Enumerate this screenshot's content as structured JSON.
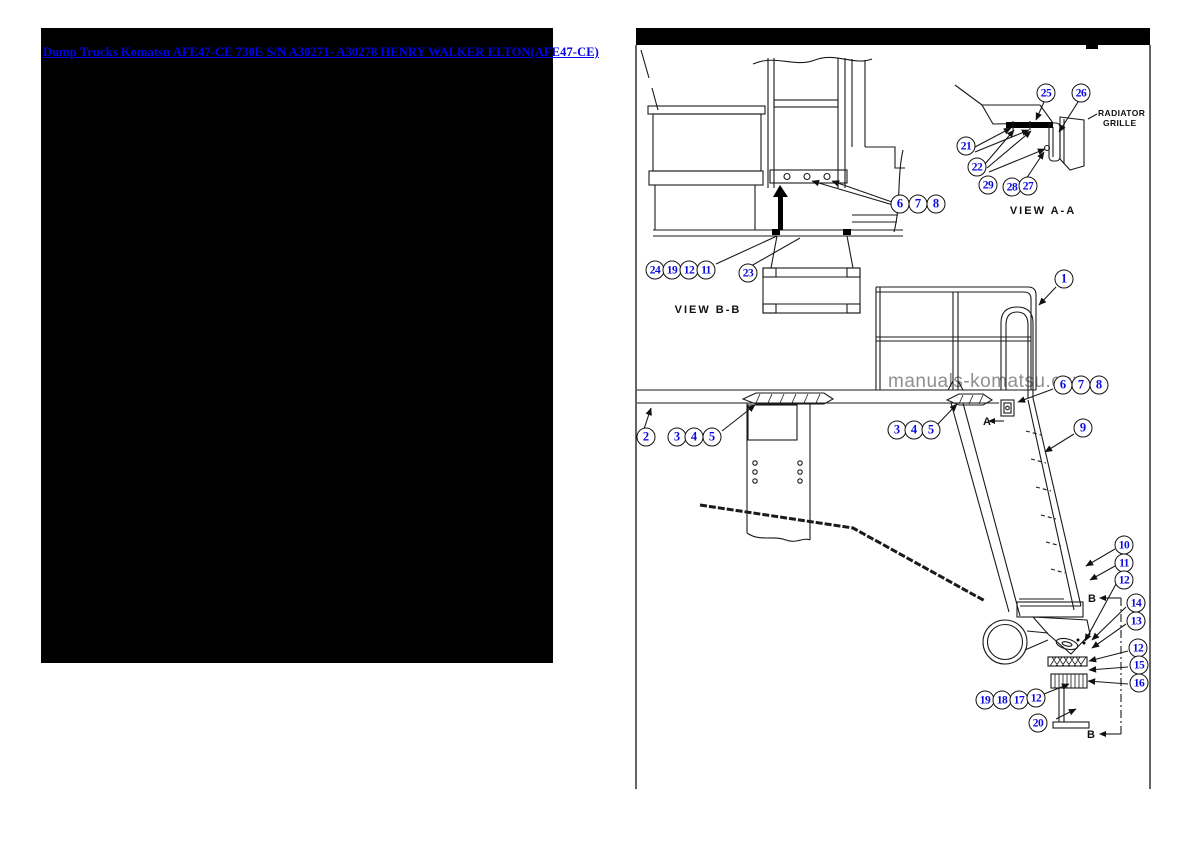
{
  "header_link": {
    "text": "Dump Trucks Komatsu AFE47-CE 730E S/N A30271- A30278 HENRY WALKER ELTON(AFE47-CE)",
    "color": "#0000ee"
  },
  "watermark": {
    "text": "manuals-komatsu.com",
    "color": "#8f8f8f"
  },
  "diagram": {
    "labels": {
      "view_aa": "VIEW A-A",
      "view_bb": "VIEW B-B",
      "radiator_line1": "RADIATOR",
      "radiator_line2": "GRILLE",
      "section_a": "A",
      "section_b": "B"
    },
    "callout_color": "#0a0ae0",
    "callouts": [
      {
        "n": "6",
        "x": 900,
        "y": 204
      },
      {
        "n": "7",
        "x": 918,
        "y": 204
      },
      {
        "n": "8",
        "x": 936,
        "y": 204
      },
      {
        "n": "24",
        "x": 655,
        "y": 270
      },
      {
        "n": "19",
        "x": 672,
        "y": 270
      },
      {
        "n": "12",
        "x": 689,
        "y": 270
      },
      {
        "n": "11",
        "x": 706,
        "y": 270
      },
      {
        "n": "23",
        "x": 748,
        "y": 273
      },
      {
        "n": "21",
        "x": 966,
        "y": 146
      },
      {
        "n": "22",
        "x": 977,
        "y": 167
      },
      {
        "n": "29",
        "x": 988,
        "y": 185
      },
      {
        "n": "28",
        "x": 1012,
        "y": 187
      },
      {
        "n": "27",
        "x": 1028,
        "y": 186
      },
      {
        "n": "25",
        "x": 1046,
        "y": 93
      },
      {
        "n": "26",
        "x": 1081,
        "y": 93
      },
      {
        "n": "1",
        "x": 1064,
        "y": 279
      },
      {
        "n": "6",
        "x": 1063,
        "y": 385
      },
      {
        "n": "7",
        "x": 1081,
        "y": 385
      },
      {
        "n": "8",
        "x": 1099,
        "y": 385
      },
      {
        "n": "9",
        "x": 1083,
        "y": 428
      },
      {
        "n": "2",
        "x": 646,
        "y": 437
      },
      {
        "n": "3",
        "x": 677,
        "y": 437
      },
      {
        "n": "4",
        "x": 694,
        "y": 437
      },
      {
        "n": "5",
        "x": 712,
        "y": 437
      },
      {
        "n": "3",
        "x": 897,
        "y": 430
      },
      {
        "n": "4",
        "x": 914,
        "y": 430
      },
      {
        "n": "5",
        "x": 931,
        "y": 430
      },
      {
        "n": "10",
        "x": 1124,
        "y": 545
      },
      {
        "n": "11",
        "x": 1124,
        "y": 563
      },
      {
        "n": "12",
        "x": 1124,
        "y": 580
      },
      {
        "n": "14",
        "x": 1136,
        "y": 603
      },
      {
        "n": "13",
        "x": 1136,
        "y": 621
      },
      {
        "n": "12",
        "x": 1138,
        "y": 648
      },
      {
        "n": "15",
        "x": 1139,
        "y": 665
      },
      {
        "n": "16",
        "x": 1139,
        "y": 683
      },
      {
        "n": "19",
        "x": 985,
        "y": 700
      },
      {
        "n": "18",
        "x": 1002,
        "y": 700
      },
      {
        "n": "17",
        "x": 1019,
        "y": 700
      },
      {
        "n": "12",
        "x": 1036,
        "y": 698
      },
      {
        "n": "20",
        "x": 1038,
        "y": 723
      }
    ]
  }
}
